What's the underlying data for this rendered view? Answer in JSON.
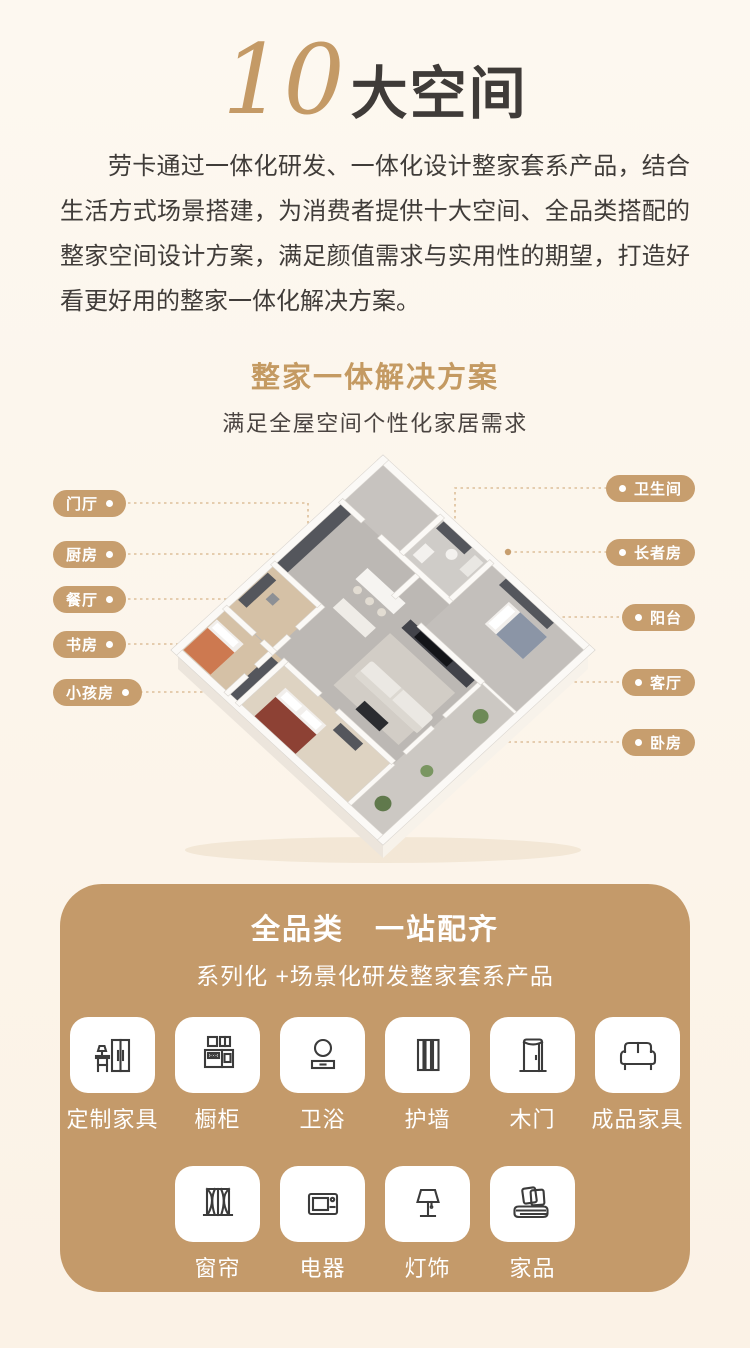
{
  "hero": {
    "number": "10",
    "title": "大空间",
    "paragraph": "劳卡通过一体化研发、一体化设计整家套系产品，结合生活方式场景搭建，为消费者提供十大空间、全品类搭配的整家空间设计方案，满足颜值需求与实用性的期望，打造好看更好用的整家一体化解决方案。"
  },
  "solution": {
    "heading": "整家一体解决方案",
    "subheading": "满足全屋空间个性化家居需求"
  },
  "floorplan": {
    "left_labels": [
      "门厅",
      "厨房",
      "餐厅",
      "书房",
      "小孩房"
    ],
    "right_labels": [
      "卫生间",
      "长者房",
      "阳台",
      "客厅",
      "卧房"
    ]
  },
  "catalog": {
    "title": "全品类　一站配齐",
    "subtitle": "系列化 +场景化研发整家套系产品",
    "items": [
      {
        "label": "定制家具",
        "icon": "custom-furniture-icon"
      },
      {
        "label": "橱柜",
        "icon": "kitchen-cabinet-icon"
      },
      {
        "label": "卫浴",
        "icon": "bathroom-icon"
      },
      {
        "label": "护墙",
        "icon": "wall-panel-icon"
      },
      {
        "label": "木门",
        "icon": "wooden-door-icon"
      },
      {
        "label": "成品家具",
        "icon": "sofa-icon"
      },
      {
        "label": "窗帘",
        "icon": "curtain-icon"
      },
      {
        "label": "电器",
        "icon": "appliance-icon"
      },
      {
        "label": "灯饰",
        "icon": "lamp-icon"
      },
      {
        "label": "家品",
        "icon": "bedding-icon"
      }
    ]
  },
  "colors": {
    "background": "#fcf4ea",
    "accent_gold": "#c49a6a",
    "pill_gold": "#c79e6e",
    "text_dark": "#3f3b38",
    "white": "#ffffff"
  }
}
